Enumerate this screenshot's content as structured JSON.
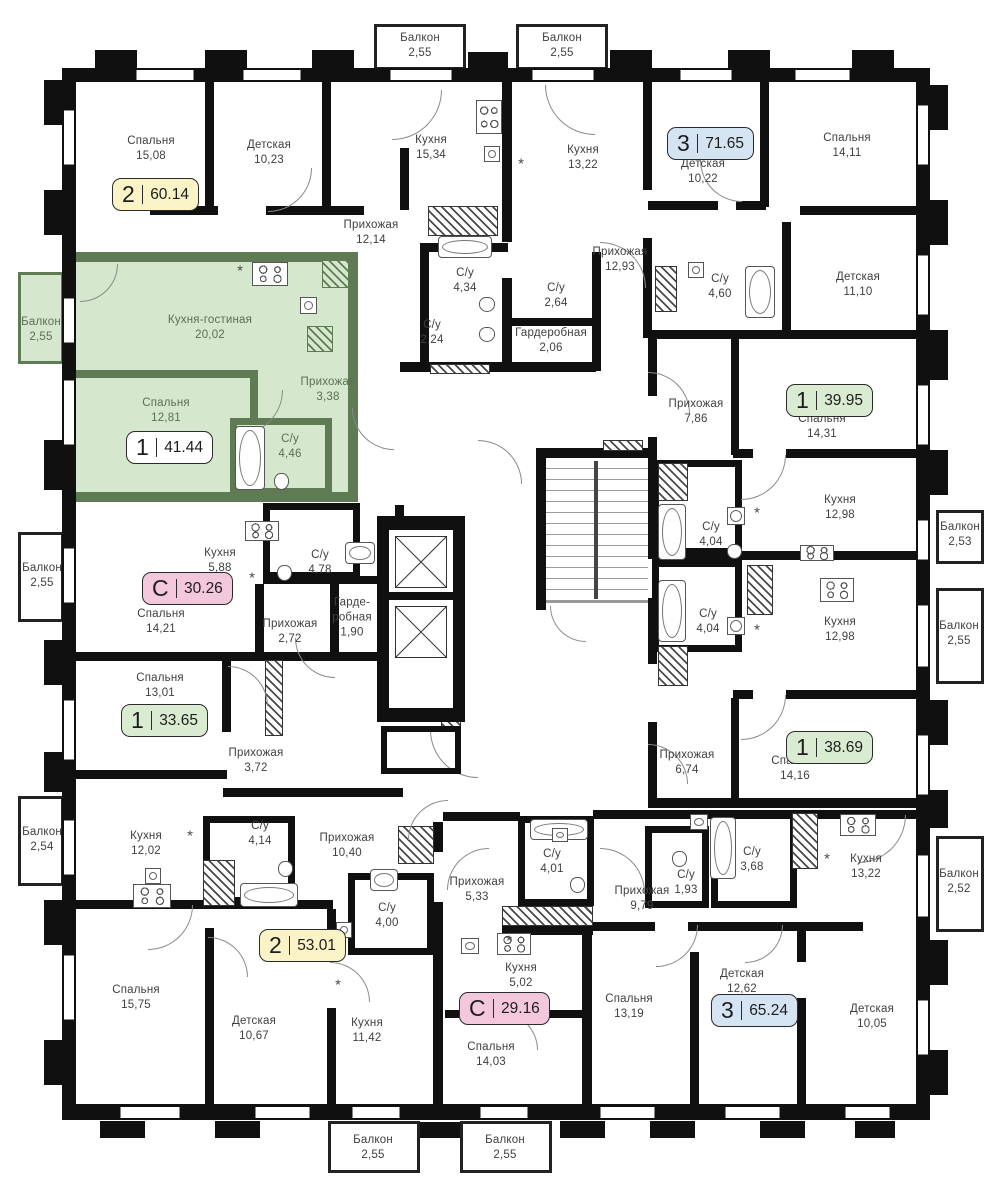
{
  "plan": {
    "type": "residential-floor-plan",
    "language": "ru",
    "colors": {
      "wall": "#101010",
      "green_wall": "#5e7b54",
      "green_fill": "#d5e8cd",
      "badge_yellow": "#f9f3c5",
      "badge_blue": "#d4e4f3",
      "badge_green": "#d9ecd1",
      "badge_pink": "#f3c8dd",
      "badge_white": "#ffffff"
    },
    "highlighted_apartment": {
      "rooms": "1",
      "area": "41.44"
    },
    "badges": [
      {
        "rooms": "2",
        "area": "60.14",
        "color": "badge_yellow",
        "x": 112,
        "y": 178
      },
      {
        "rooms": "3",
        "area": "71.65",
        "color": "badge_blue",
        "x": 667,
        "y": 127
      },
      {
        "rooms": "1",
        "area": "41.44",
        "color": "badge_white",
        "x": 126,
        "y": 431
      },
      {
        "rooms": "1",
        "area": "39.95",
        "color": "badge_green",
        "x": 786,
        "y": 384
      },
      {
        "rooms": "С",
        "area": "30.26",
        "color": "badge_pink",
        "x": 142,
        "y": 572
      },
      {
        "rooms": "1",
        "area": "33.65",
        "color": "badge_green",
        "x": 121,
        "y": 704
      },
      {
        "rooms": "1",
        "area": "38.69",
        "color": "badge_green",
        "x": 786,
        "y": 731
      },
      {
        "rooms": "2",
        "area": "53.01",
        "color": "badge_yellow",
        "x": 259,
        "y": 929
      },
      {
        "rooms": "С",
        "area": "29.16",
        "color": "badge_pink",
        "x": 459,
        "y": 992
      },
      {
        "rooms": "3",
        "area": "65.24",
        "color": "badge_blue",
        "x": 711,
        "y": 994
      }
    ],
    "rooms": [
      {
        "label": "Спальня",
        "area": "15,08",
        "x": 151,
        "y": 149
      },
      {
        "label": "Детская",
        "area": "10,23",
        "x": 269,
        "y": 153
      },
      {
        "label": "Кухня",
        "area": "15,34",
        "x": 431,
        "y": 148
      },
      {
        "label": "Прихожая",
        "area": "12,14",
        "x": 371,
        "y": 233
      },
      {
        "label": "Кухня",
        "area": "13,22",
        "x": 583,
        "y": 158
      },
      {
        "label": "Детская",
        "area": "10,22",
        "x": 703,
        "y": 172
      },
      {
        "label": "Спальня",
        "area": "14,11",
        "x": 847,
        "y": 146
      },
      {
        "label": "Прихожая",
        "area": "12,93",
        "x": 620,
        "y": 260
      },
      {
        "label": "С/у",
        "area": "4,34",
        "x": 465,
        "y": 281
      },
      {
        "label": "С/у",
        "area": "2,64",
        "x": 556,
        "y": 296
      },
      {
        "label": "С/у",
        "area": "2,24",
        "x": 432,
        "y": 333
      },
      {
        "label": "Гардеробная",
        "area": "2,06",
        "x": 551,
        "y": 341
      },
      {
        "label": "С/у",
        "area": "4,60",
        "x": 720,
        "y": 287
      },
      {
        "label": "Детская",
        "area": "11,10",
        "x": 858,
        "y": 285
      },
      {
        "label": "Кухня-гостиная",
        "area": "20,02",
        "x": 210,
        "y": 328,
        "green": true
      },
      {
        "label": "Спальня",
        "area": "12,81",
        "x": 166,
        "y": 411,
        "green": true
      },
      {
        "label": "Прихожая",
        "area": "3,38",
        "x": 328,
        "y": 390,
        "green": true
      },
      {
        "label": "С/у",
        "area": "4,46",
        "x": 290,
        "y": 447,
        "green": true
      },
      {
        "label": "Прихожая",
        "area": "7,86",
        "x": 696,
        "y": 412
      },
      {
        "label": "Спальня",
        "area": "14,31",
        "x": 822,
        "y": 427
      },
      {
        "label": "Кухня",
        "area": "12,98",
        "x": 840,
        "y": 508
      },
      {
        "label": "С/у",
        "area": "4,04",
        "x": 711,
        "y": 535
      },
      {
        "label": "С/у",
        "area": "4,04",
        "x": 708,
        "y": 622
      },
      {
        "label": "Кухня",
        "area": "12,98",
        "x": 840,
        "y": 630
      },
      {
        "label": "Кухня",
        "area": "5,88",
        "x": 220,
        "y": 561
      },
      {
        "label": "С/у",
        "area": "4,78",
        "x": 320,
        "y": 563
      },
      {
        "label": "Спальня",
        "area": "14,21",
        "x": 161,
        "y": 622
      },
      {
        "label": "Прихожая",
        "area": "2,72",
        "x": 290,
        "y": 632
      },
      {
        "label": "Гарде-\nробная",
        "area": "1,90",
        "x": 352,
        "y": 618
      },
      {
        "label": "Спальня",
        "area": "13,01",
        "x": 160,
        "y": 686
      },
      {
        "label": "Прихожая",
        "area": "3,72",
        "x": 256,
        "y": 761
      },
      {
        "label": "Прихожая",
        "area": "6,74",
        "x": 687,
        "y": 763
      },
      {
        "label": "Спальня",
        "area": "14,16",
        "x": 795,
        "y": 769
      },
      {
        "label": "Кухня",
        "area": "12,02",
        "x": 146,
        "y": 844
      },
      {
        "label": "С/у",
        "area": "4,14",
        "x": 260,
        "y": 834
      },
      {
        "label": "Прихожая",
        "area": "10,40",
        "x": 347,
        "y": 846
      },
      {
        "label": "С/у",
        "area": "4,00",
        "x": 387,
        "y": 916
      },
      {
        "label": "Спальня",
        "area": "15,75",
        "x": 136,
        "y": 998
      },
      {
        "label": "Детская",
        "area": "10,67",
        "x": 254,
        "y": 1029
      },
      {
        "label": "Кухня",
        "area": "11,42",
        "x": 367,
        "y": 1031
      },
      {
        "label": "Прихожая",
        "area": "5,33",
        "x": 477,
        "y": 890
      },
      {
        "label": "С/у",
        "area": "4,01",
        "x": 552,
        "y": 862
      },
      {
        "label": "Кухня",
        "area": "5,02",
        "x": 521,
        "y": 976
      },
      {
        "label": "Спальня",
        "area": "14,03",
        "x": 491,
        "y": 1055
      },
      {
        "label": "Прихожая",
        "area": "9,79",
        "x": 642,
        "y": 899
      },
      {
        "label": "Спальня",
        "area": "13,19",
        "x": 629,
        "y": 1007
      },
      {
        "label": "С/у",
        "area": "1,93",
        "x": 686,
        "y": 883
      },
      {
        "label": "С/у",
        "area": "3,68",
        "x": 752,
        "y": 860
      },
      {
        "label": "Кухня",
        "area": "13,22",
        "x": 866,
        "y": 867
      },
      {
        "label": "Детская",
        "area": "12,62",
        "x": 742,
        "y": 982
      },
      {
        "label": "Детская",
        "area": "10,05",
        "x": 872,
        "y": 1017
      }
    ],
    "balconies": [
      {
        "label": "Балкон",
        "area": "2,55",
        "x": 420,
        "y": 46
      },
      {
        "label": "Балкон",
        "area": "2,55",
        "x": 562,
        "y": 46
      },
      {
        "label": "Балкон",
        "area": "2,55",
        "x": 41,
        "y": 330,
        "green": true
      },
      {
        "label": "Балкон",
        "area": "2,55",
        "x": 42,
        "y": 576
      },
      {
        "label": "Балкон",
        "area": "2,54",
        "x": 42,
        "y": 840
      },
      {
        "label": "Балкон",
        "area": "2,53",
        "x": 960,
        "y": 535
      },
      {
        "label": "Балкон",
        "area": "2,55",
        "x": 959,
        "y": 634
      },
      {
        "label": "Балкон",
        "area": "2,52",
        "x": 959,
        "y": 882
      },
      {
        "label": "Балкон",
        "area": "2,55",
        "x": 373,
        "y": 1148
      },
      {
        "label": "Балкон",
        "area": "2,55",
        "x": 505,
        "y": 1148
      }
    ]
  }
}
